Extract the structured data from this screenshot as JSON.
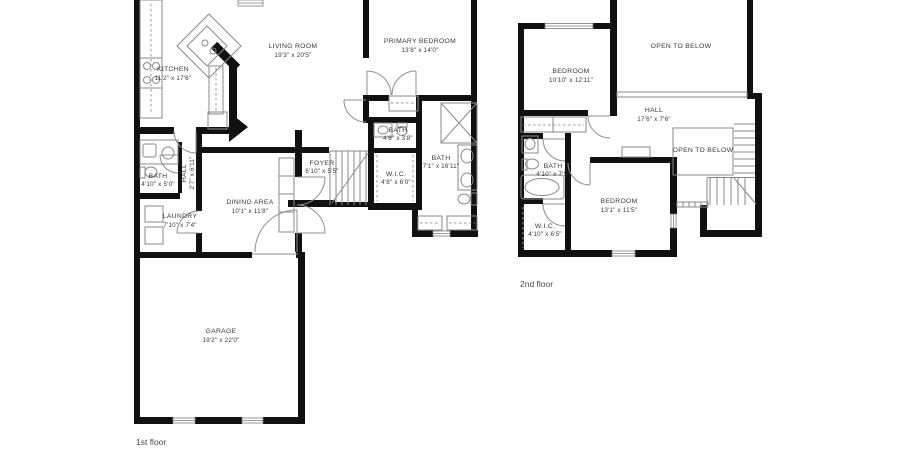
{
  "colors": {
    "background": "#ffffff",
    "wall": "#111111",
    "fixture_line": "#8a8a8a",
    "label_text": "#3a3a3a"
  },
  "floor1": {
    "label": "1st floor",
    "rooms": {
      "kitchen": {
        "name": "KITCHEN",
        "dims": "11'2\" x 17'6\""
      },
      "living": {
        "name": "LIVING ROOM",
        "dims": "19'3\" x 20'5\""
      },
      "primary": {
        "name": "PRIMARY BEDROOM",
        "dims": "13'8\" x 14'0\""
      },
      "bath_small": {
        "name": "BATH",
        "dims": "4'8\" x 3'8\""
      },
      "wic": {
        "name": "W.I.C.",
        "dims": "4'8\" x 6'0\""
      },
      "bath_primary": {
        "name": "BATH",
        "dims": "7'1\" x 16'11\""
      },
      "foyer": {
        "name": "FOYER",
        "dims": "6'10\" x 5'5\""
      },
      "dining": {
        "name": "DINING AREA",
        "dims": "10'1\" x 11'8\""
      },
      "hall": {
        "name": "HALL",
        "dims": "2'7\" x 6'11\""
      },
      "bath_hall": {
        "name": "BATH",
        "dims": "4'10\" x 5'0\""
      },
      "laundry": {
        "name": "LAUNDRY",
        "dims": "7'10\" x 7'4\""
      },
      "garage": {
        "name": "GARAGE",
        "dims": "19'2\" x 22'0\""
      }
    }
  },
  "floor2": {
    "label": "2nd floor",
    "rooms": {
      "bedroom2": {
        "name": "BEDROOM",
        "dims": "10'10\" x 12'11\""
      },
      "open_below_main": {
        "name": "OPEN TO BELOW"
      },
      "hall": {
        "name": "HALL",
        "dims": "17'6\" x 7'6\""
      },
      "bath": {
        "name": "BATH",
        "dims": "4'10\" x 7'5\""
      },
      "wic": {
        "name": "W.I.C.",
        "dims": "4'10\" x 6'5\""
      },
      "bedroom3": {
        "name": "BEDROOM",
        "dims": "13'1\" x 11'5\""
      },
      "open_below_stair": {
        "name": "OPEN TO BELOW"
      }
    }
  }
}
